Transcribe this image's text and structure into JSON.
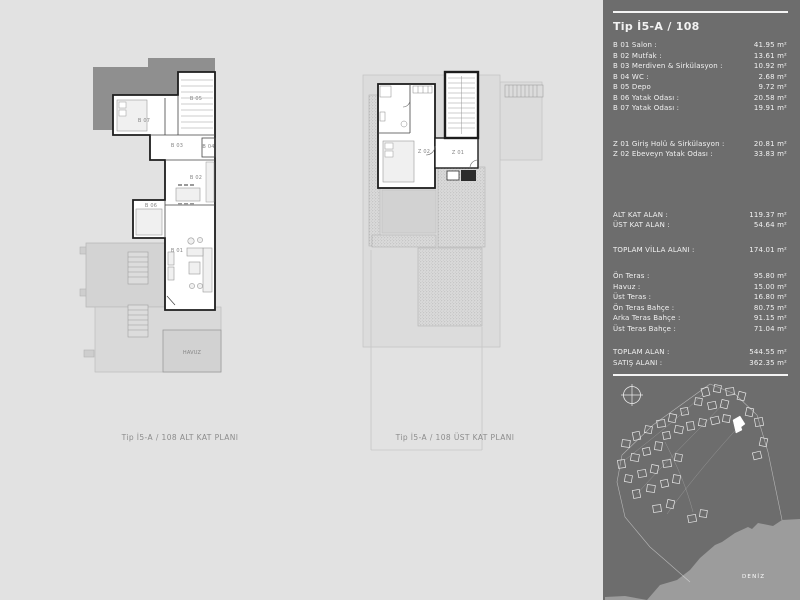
{
  "colors": {
    "page_bg": "#e2e2e2",
    "sidebar_bg": "#6d6d6d",
    "sea": "#9c9c9c",
    "dark_mass": "#8f8f8f",
    "wall": "#1d1d1d",
    "text_light": "#f2f2f2"
  },
  "plans": {
    "left": {
      "caption": "Tip İ5-A / 108 ALT KAT PLANI",
      "room_labels": [
        "B 05",
        "B 07",
        "B 03",
        "B 04",
        "B 02",
        "B 06",
        "B 01"
      ],
      "pool_label": "HAVUZ"
    },
    "right": {
      "caption": "Tip İ5-A / 108 ÜST KAT PLANI",
      "room_labels": [
        "Z 02",
        "Z 01"
      ]
    }
  },
  "sidebar": {
    "title": "Tip İ5-A / 108",
    "b_rooms": [
      {
        "label": "B 01 Salon :",
        "value": "41.95 m²"
      },
      {
        "label": "B 02 Mutfak :",
        "value": "13.61 m²"
      },
      {
        "label": "B 03 Merdiven & Sirkülasyon :",
        "value": "10.92 m²"
      },
      {
        "label": "B 04 WC :",
        "value": "2.68 m²"
      },
      {
        "label": "B 05 Depo",
        "value": "9.72 m²"
      },
      {
        "label": "B 06 Yatak Odası :",
        "value": "20.58 m²"
      },
      {
        "label": "B 07 Yatak Odası :",
        "value": "19.91 m²"
      }
    ],
    "z_rooms": [
      {
        "label": "Z 01 Giriş Holü & Sirkülasyon :",
        "value": "20.81 m²"
      },
      {
        "label": "Z 02 Ebeveyn Yatak Odası :",
        "value": "33.83 m²"
      }
    ],
    "kat": [
      {
        "label": "ALT KAT ALAN :",
        "value": "119.37 m²"
      },
      {
        "label": "ÜST KAT ALAN :",
        "value": "54.64 m²"
      }
    ],
    "villa": [
      {
        "label": "TOPLAM VİLLA ALANI :",
        "value": "174.01 m²"
      }
    ],
    "teras": [
      {
        "label": "Ön Teras :",
        "value": "95.80 m²"
      },
      {
        "label": "Havuz :",
        "value": "15.00 m²"
      },
      {
        "label": "Üst Teras :",
        "value": "16.80 m²"
      },
      {
        "label": "Ön Teras Bahçe :",
        "value": "80.75 m²"
      },
      {
        "label": "Arka Teras Bahçe :",
        "value": "91.15 m²"
      },
      {
        "label": "Üst Teras Bahçe :",
        "value": "71.04 m²"
      }
    ],
    "toplam": [
      {
        "label": "TOPLAM ALAN :",
        "value": "544.55 m²"
      },
      {
        "label": "SATIŞ ALANI :",
        "value": "362.35 m²"
      }
    ],
    "map": {
      "sea_label": "DENİZ"
    }
  }
}
